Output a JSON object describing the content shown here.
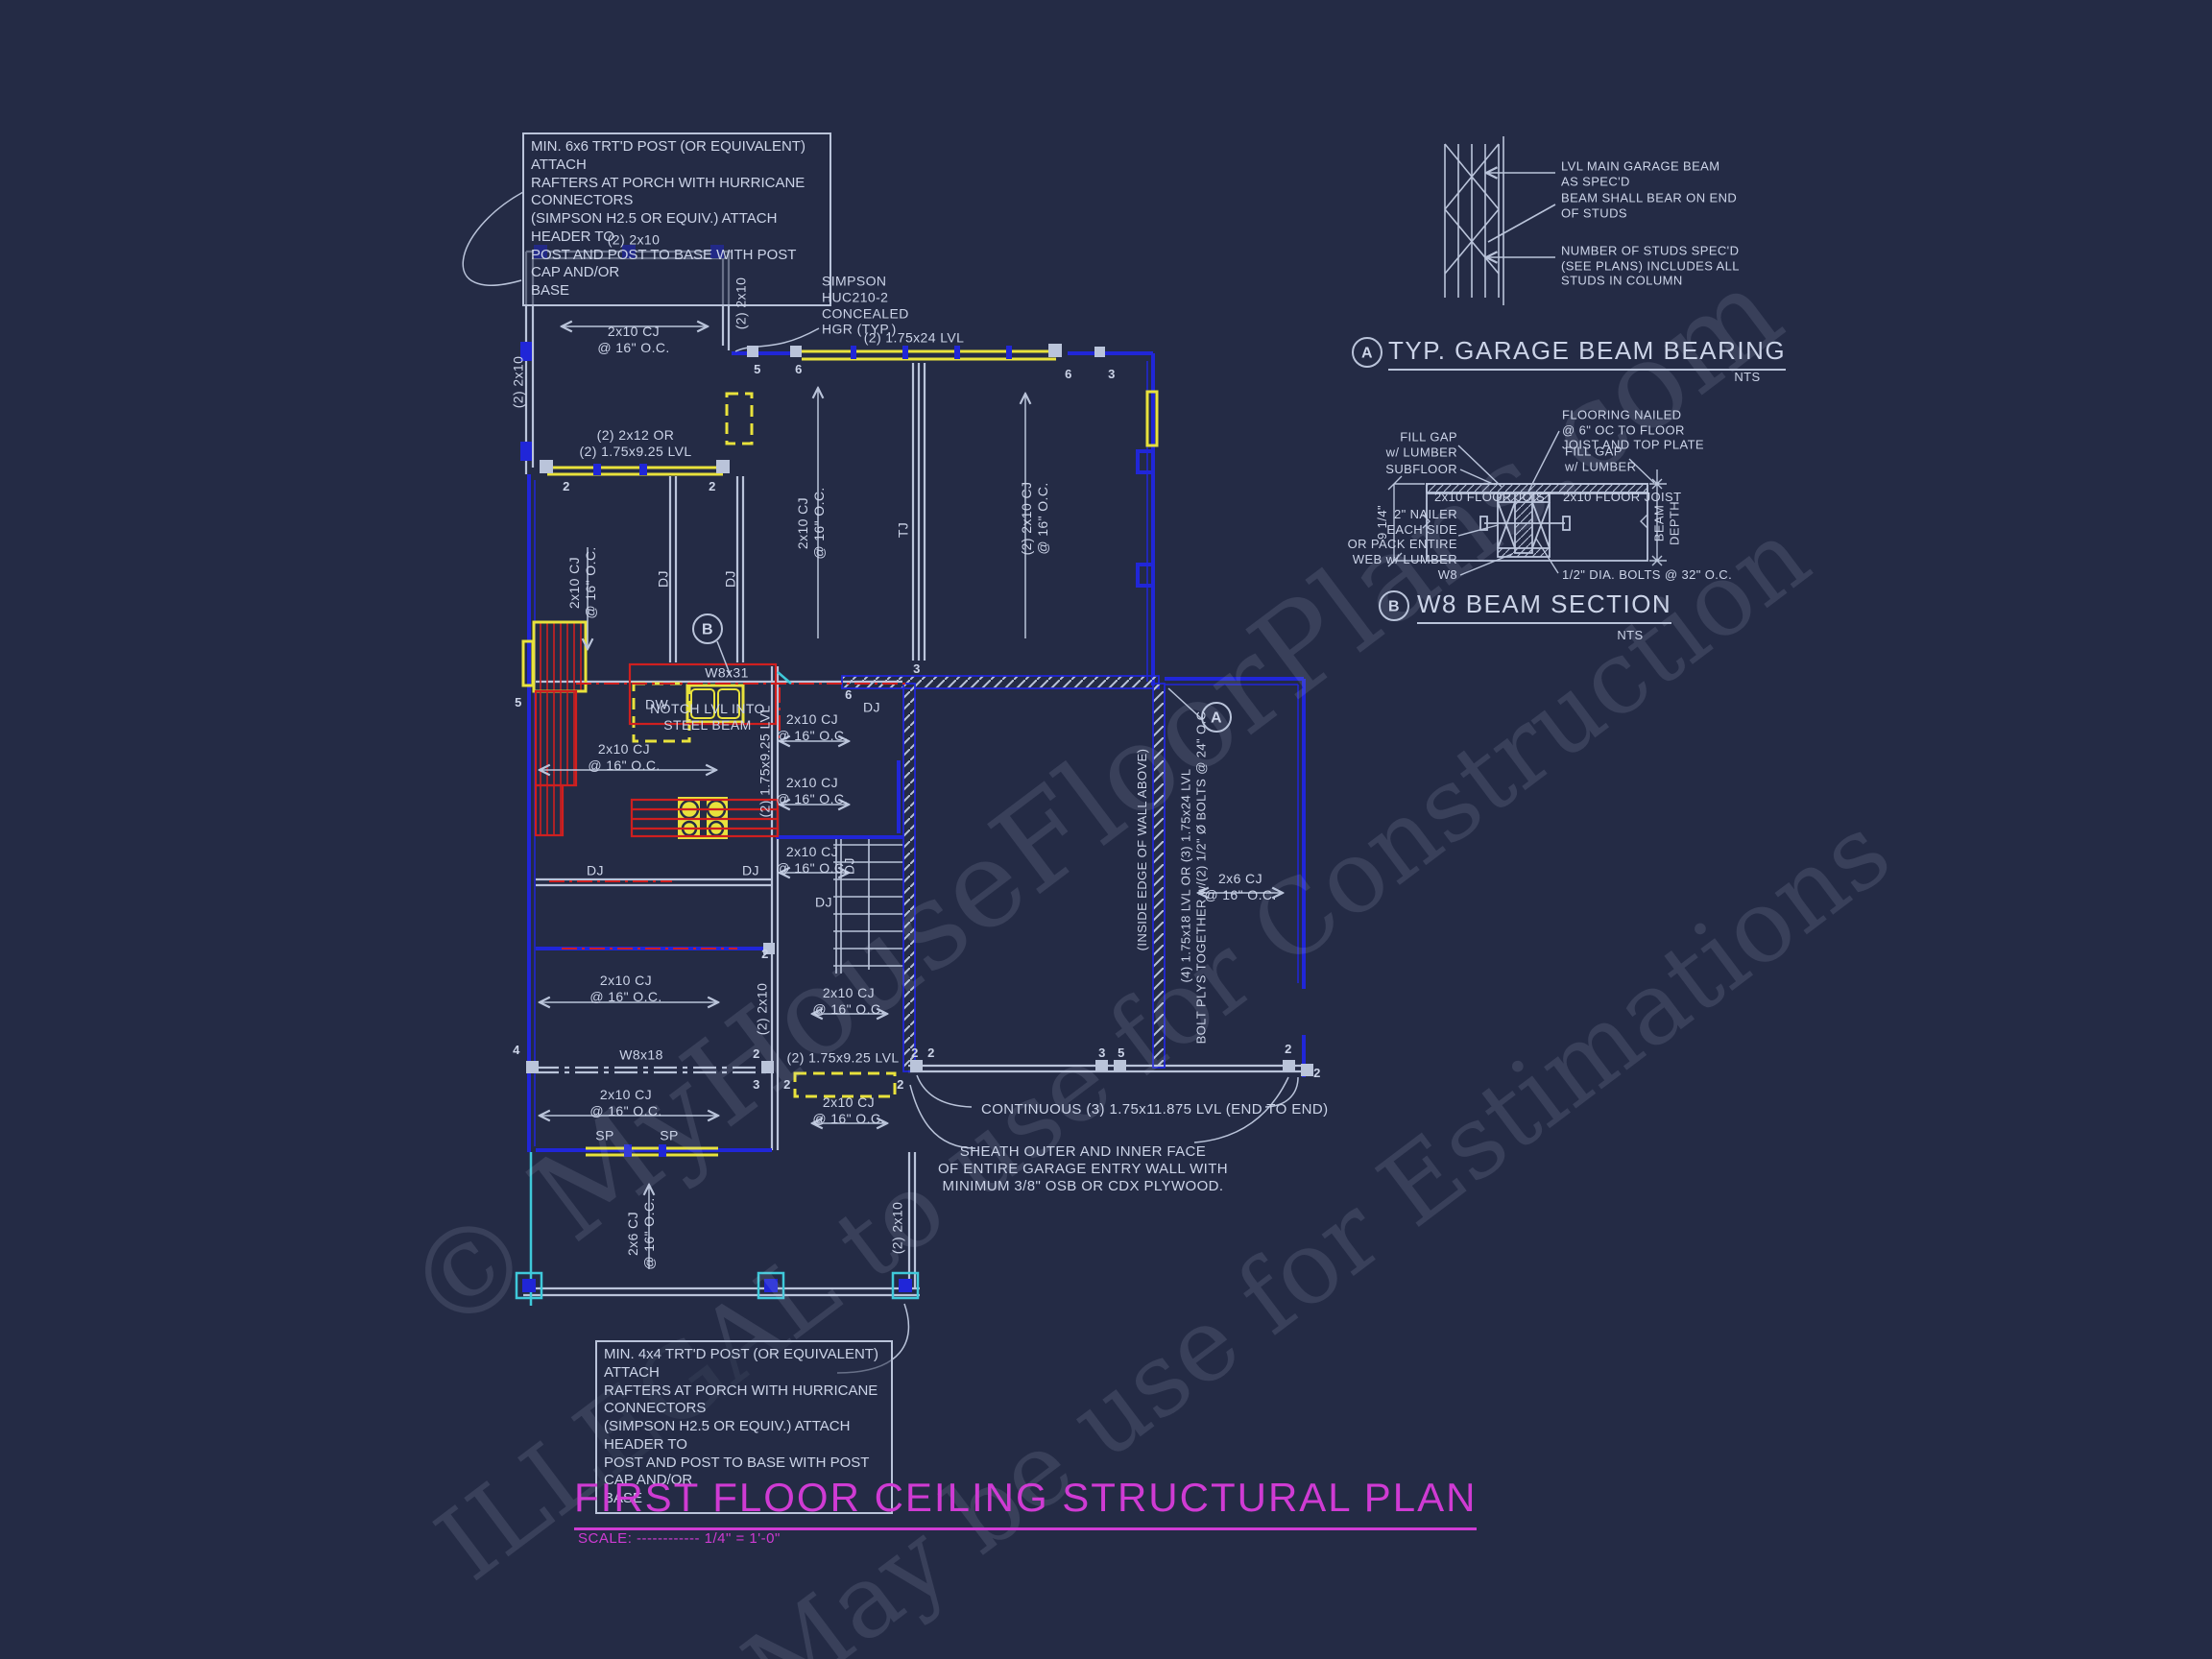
{
  "page": {
    "background": "#242b45"
  },
  "colors": {
    "line": "#bac4da",
    "text": "#ccd4e8",
    "blue": "#2026d8",
    "yellow": "#e8e23c",
    "red": "#cf1f1f",
    "cyan": "#3fc9da",
    "magenta": "#cf3bd3"
  },
  "watermark": {
    "line1": "© MyHouseFloorPlans.com",
    "line2": "ILLEGAL to use for Construction",
    "line3": "May be use for Estimations"
  },
  "title_block": {
    "title": "FIRST FLOOR CEILING STRUCTURAL PLAN",
    "scale": "SCALE: ------------ 1/4\" = 1'-0\""
  },
  "notes": {
    "post_6x6": "MIN. 6x6 TRT'D POST (OR EQUIVALENT) ATTACH\nRAFTERS AT PORCH WITH HURRICANE CONNECTORS\n(SIMPSON H2.5 OR EQUIV.) ATTACH HEADER TO\nPOST AND POST TO BASE WITH POST CAP AND/OR\nBASE",
    "post_4x4": "MIN. 4x4 TRT'D POST (OR EQUIVALENT) ATTACH\nRAFTERS AT PORCH WITH HURRICANE CONNECTORS\n(SIMPSON H2.5 OR EQUIV.) ATTACH HEADER TO\nPOST AND POST TO BASE WITH POST CAP AND/OR\nBASE",
    "simpson": "SIMPSON\nHUC210-2\nCONCEALED\nHGR (TYP.)",
    "continuous_lvl": "CONTINUOUS (3) 1.75x11.875 LVL (END TO END)",
    "sheath": "SHEATH OUTER AND INNER FACE\nOF ENTIRE GARAGE ENTRY WALL WITH\nMINIMUM 3/8\" OSB OR CDX PLYWOOD."
  },
  "labels": {
    "beam_2x10": "(2) 2x10",
    "cj_2x10": "2x10 CJ\n@ 16\" O.C.",
    "cj_2x10_dbl": "(2) 2x10 CJ\n@ 16\" O.C.",
    "cj_2x6": "2x6 CJ\n@ 16\" O.C.",
    "porch_beam": "(2) 2x12 OR\n(2) 1.75x9.25 LVL",
    "garage_lvl": "(2) 1.75x24 LVL",
    "lvl_925": "(2) 1.75x9.25 LVL",
    "tj": "TJ",
    "dj": "DJ",
    "dw": "DW",
    "sp": "SP",
    "w8x31": "W8x31",
    "w8x18": "W8x18",
    "notch": "NOTCH LVL INTO\nSTEEL BEAM",
    "inside_edge": "(INSIDE EDGE OF WALL ABOVE)",
    "entry_lvl": "(4) 1.75x18 LVL OR (3) 1.75x24 LVL\nBOLT PLYS TOGETHER w/(2) 1/2\" Ø BOLTS @ 24\" O.C."
  },
  "markers": {
    "n2": "2",
    "n3": "3",
    "n4": "4",
    "n5": "5",
    "n6": "6"
  },
  "callouts": {
    "a": "A",
    "b": "B"
  },
  "details": {
    "garage_beam_bearing": {
      "callout": "A",
      "title": "TYP. GARAGE BEAM BEARING",
      "scale": "NTS",
      "note_lvl": "LVL MAIN GARAGE BEAM\nAS SPEC'D",
      "note_bear": "BEAM SHALL BEAR ON END\nOF STUDS",
      "note_studs": "NUMBER OF STUDS SPEC'D\n(SEE PLANS) INCLUDES ALL\nSTUDS IN COLUMN"
    },
    "w8_beam_section": {
      "callout": "B",
      "title": "W8 BEAM SECTION",
      "scale": "NTS",
      "fill_gap": "FILL GAP\nw/ LUMBER",
      "subfloor": "SUBFLOOR",
      "flooring": "FLOORING NAILED\n@ 6\" OC TO FLOOR\nJOIST AND TOP PLATE",
      "floor_joist": "2x10 FLOOR JOIST",
      "nailer": "2\" NAILER\nEACH SIDE\nOR PACK ENTIRE\nWEB w/ LUMBER",
      "w8": "W8",
      "bolts": "1/2\" DIA. BOLTS @ 32\" O.C.",
      "beam_depth": "BEAM\nDEPTH",
      "depth_dim": "9 1/4\""
    }
  }
}
